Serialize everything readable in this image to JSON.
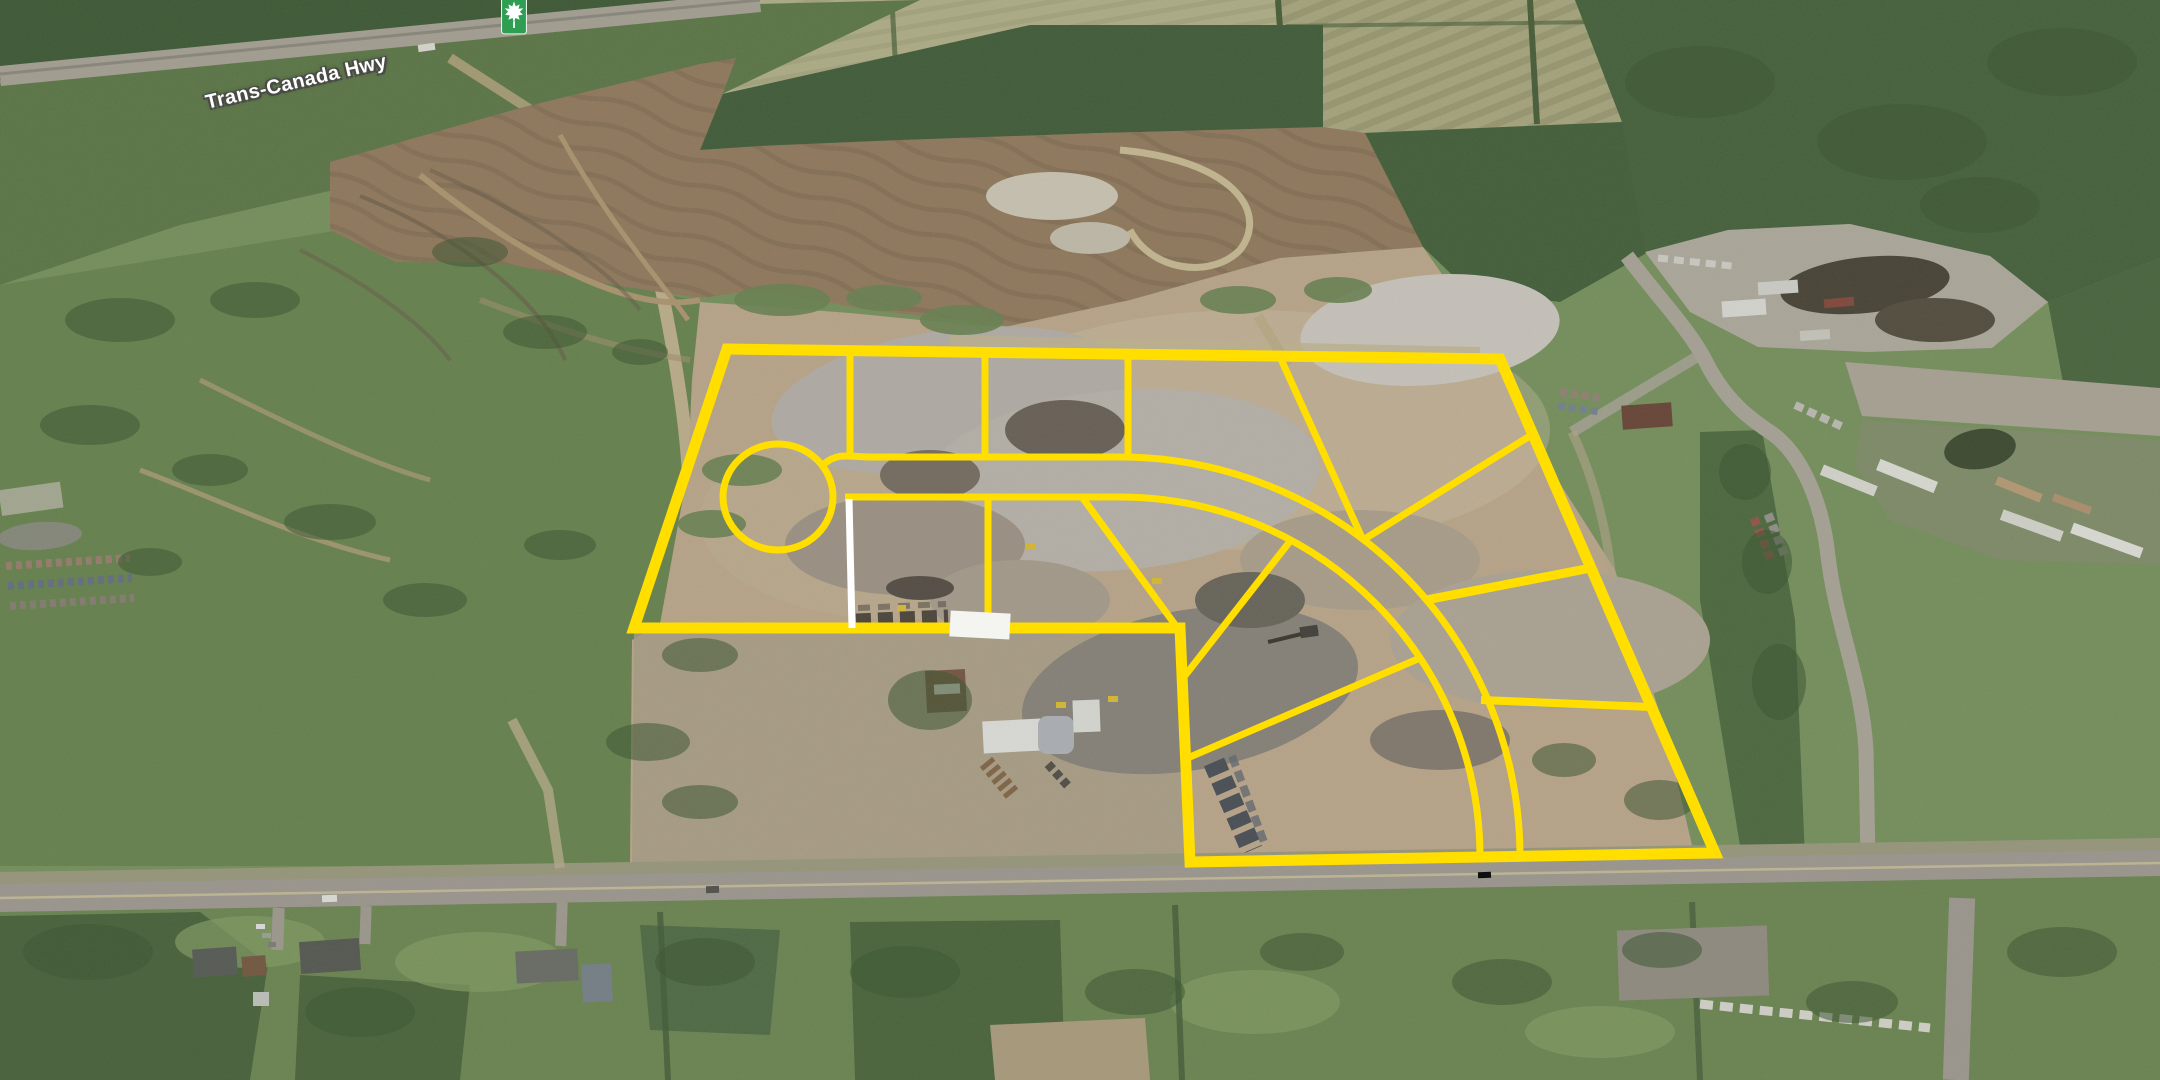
{
  "map": {
    "road_label": "Trans-Canada Hwy",
    "shield": {
      "icon": "trans-canada-maple-leaf-shield",
      "green": "#2d9e52",
      "leaf": "#ffffff"
    }
  },
  "overlay": {
    "boundary_color": "#ffde00",
    "alt_line_color": "#ffffff",
    "paths": [
      {
        "name": "site-boundary",
        "d": "M 727,349 L 1500,359 L 1715,853 L 1190,862 L 1180,628 L 634,628 Z",
        "w": 11,
        "color": "#ffde00"
      },
      {
        "name": "road-north-edge",
        "d": "M 824,464 C 838,452 848,457 872,457 L 1120,457 A 400 400 0 0 1 1520,857",
        "w": 7,
        "color": "#ffde00"
      },
      {
        "name": "road-south-edge",
        "d": "M 845,497 L 1120,497 A 360 360 0 0 1 1480,857",
        "w": 7,
        "color": "#ffde00"
      },
      {
        "name": "culdesac-loop",
        "d": "M 833,497 A 55 53 0 1 1 723,497 A 55 53 0 1 1 833,497 Z",
        "w": 7,
        "color": "#ffde00"
      },
      {
        "name": "lot-line",
        "d": "M 850,352 L 850,457",
        "w": 7,
        "color": "#ffde00"
      },
      {
        "name": "lot-line",
        "d": "M 985,353 L 985,457",
        "w": 7,
        "color": "#ffde00"
      },
      {
        "name": "lot-line",
        "d": "M 1128,355 L 1128,458",
        "w": 7,
        "color": "#ffde00"
      },
      {
        "name": "lot-line",
        "d": "M 1280,357 L 1363,540",
        "w": 7,
        "color": "#ffde00"
      },
      {
        "name": "lot-line",
        "d": "M 1363,540 L 1533,434",
        "w": 7,
        "color": "#ffde00"
      },
      {
        "name": "lot-line",
        "d": "M 1426,600 L 1591,568",
        "w": 9,
        "color": "#ffde00"
      },
      {
        "name": "lot-line",
        "d": "M 1481,700 L 1651,707",
        "w": 8,
        "color": "#ffde00"
      },
      {
        "name": "lot-line",
        "d": "M 988,497 L 988,628",
        "w": 7,
        "color": "#ffde00"
      },
      {
        "name": "lot-line",
        "d": "M 1082,497 L 1176,626",
        "w": 7,
        "color": "#ffde00"
      },
      {
        "name": "lot-line",
        "d": "M 1291,540 L 1180,682",
        "w": 7,
        "color": "#ffde00"
      },
      {
        "name": "lot-line",
        "d": "M 1183,760 L 1420,658",
        "w": 7,
        "color": "#ffde00"
      },
      {
        "name": "lot-line-alt",
        "d": "M 849,499 L 852,628",
        "w": 7,
        "color": "#ffffff"
      }
    ]
  }
}
